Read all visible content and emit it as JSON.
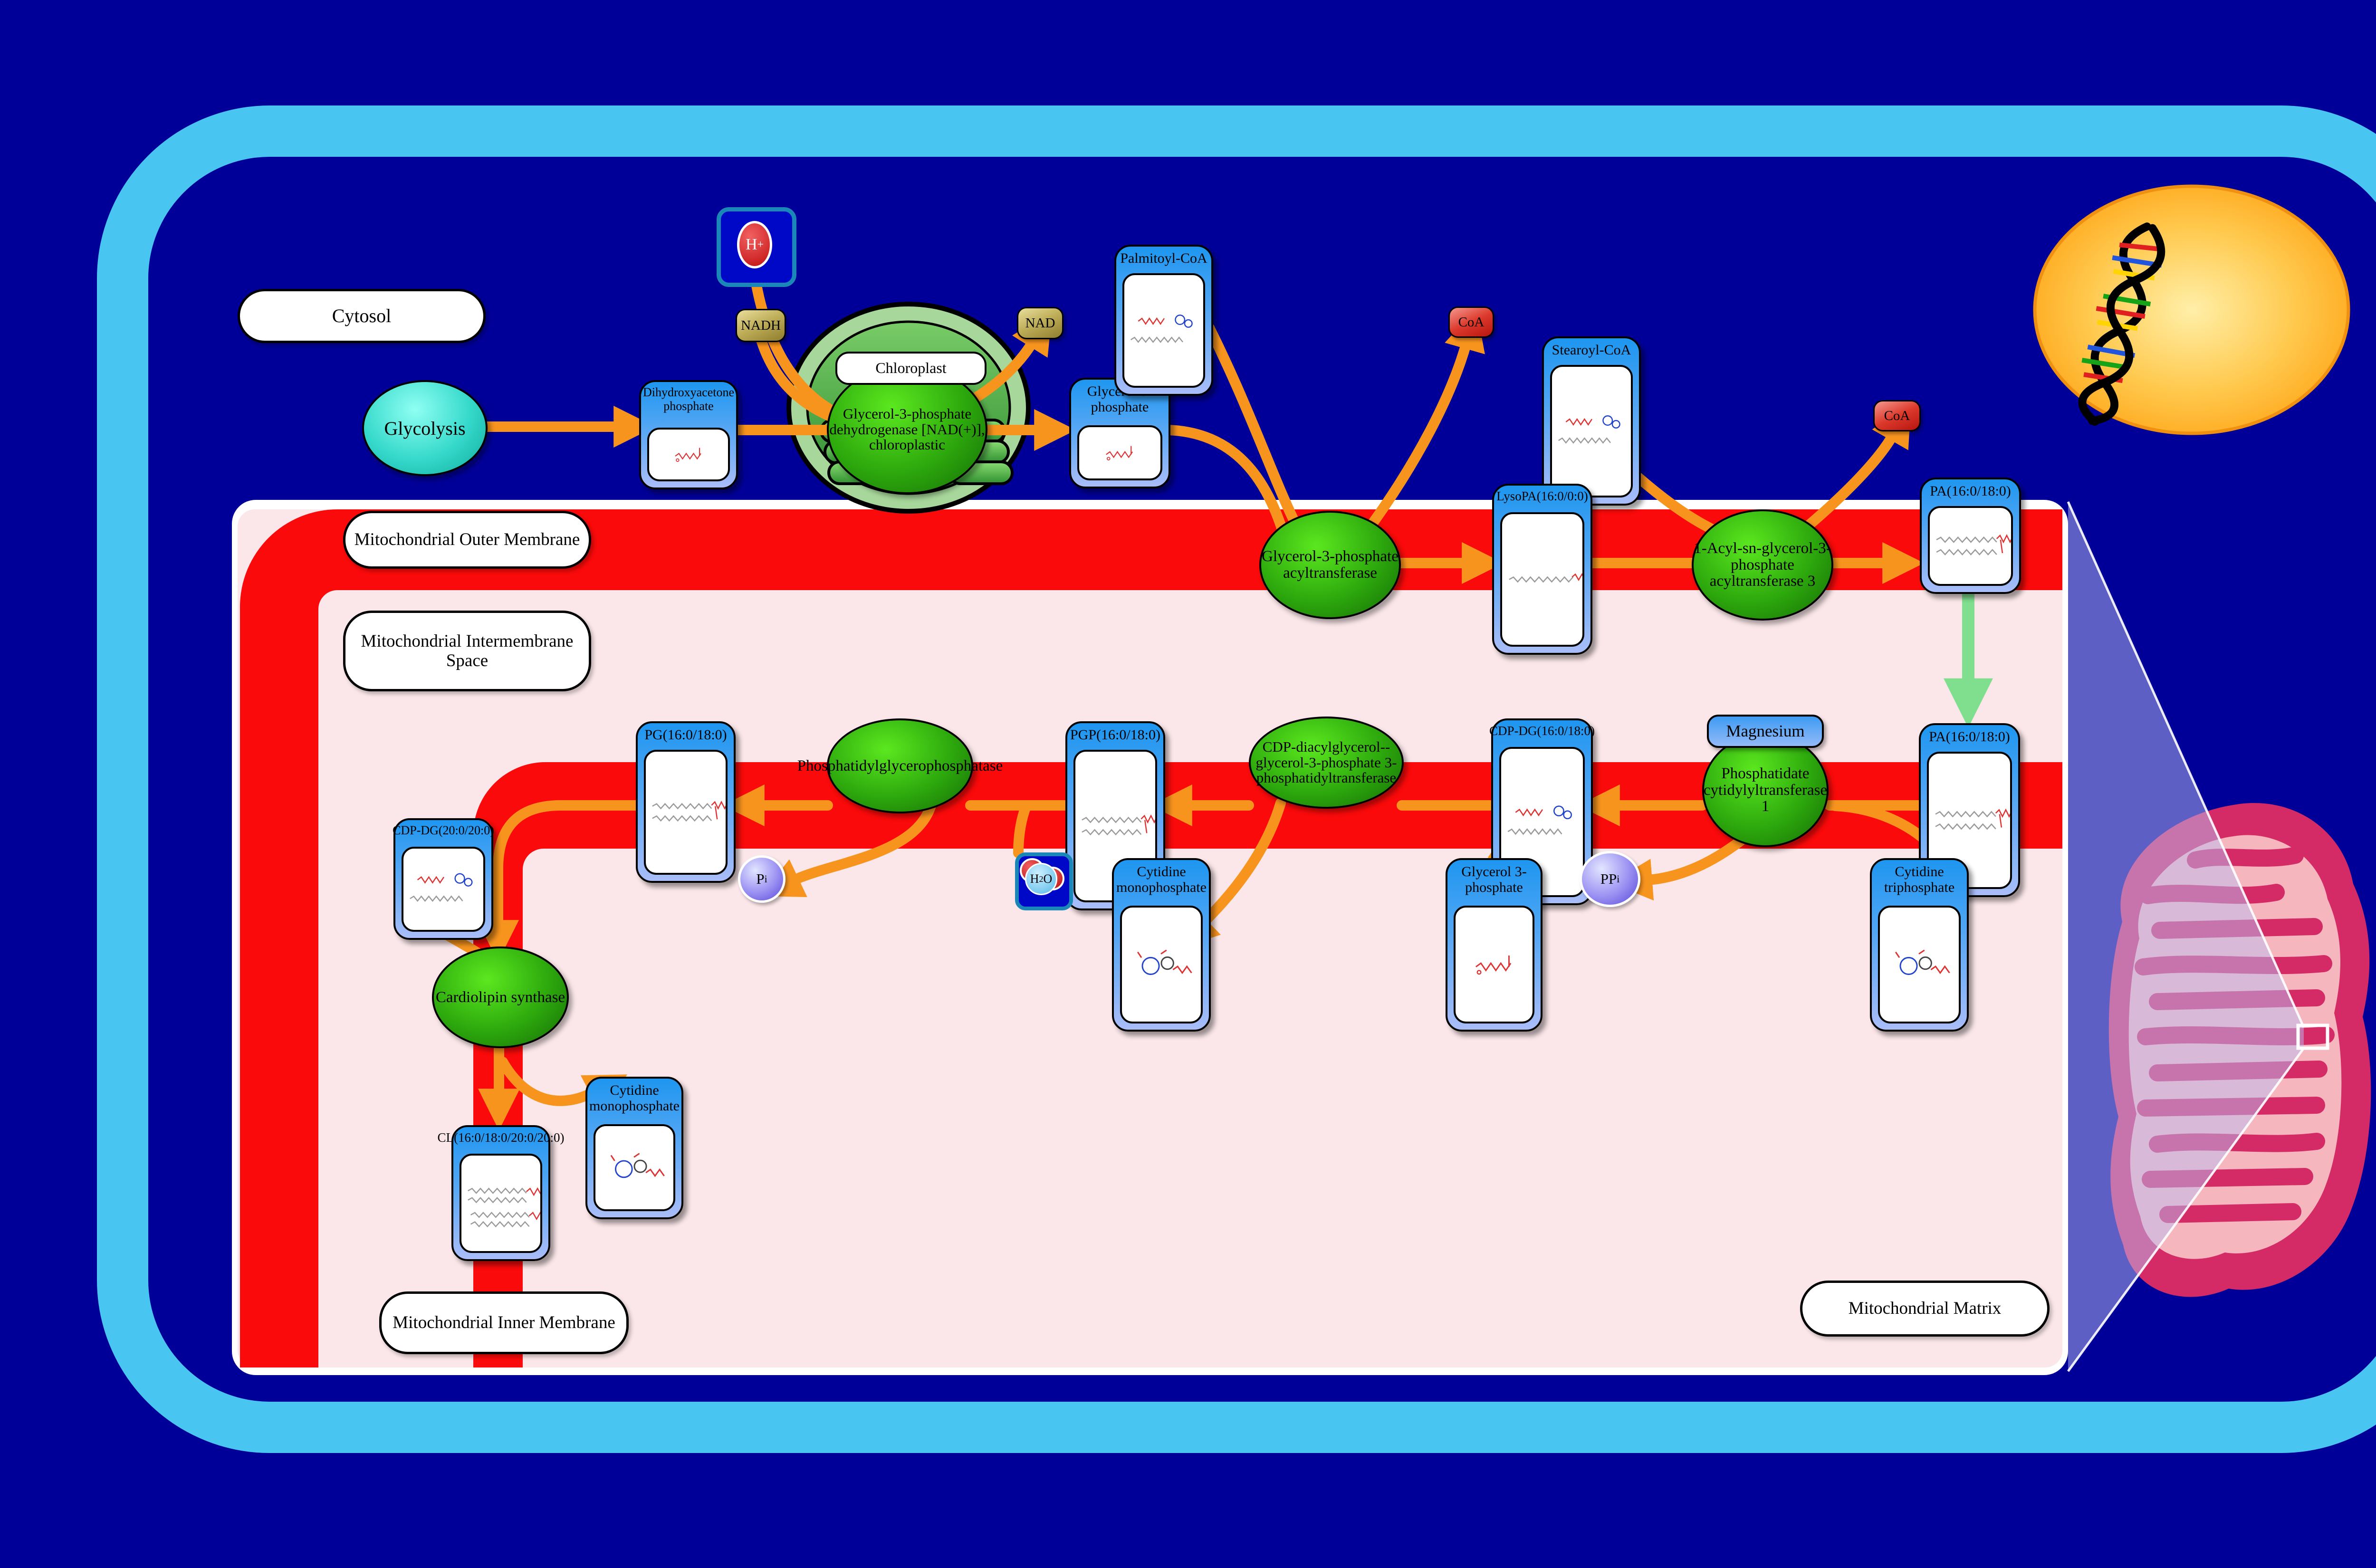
{
  "regions": {
    "cytosol": "Cytosol",
    "chloroplast": "Chloroplast",
    "outer_membrane": "Mitochondrial Outer Membrane",
    "intermembrane_space": "Mitochondrial Intermembrane Space",
    "inner_membrane": "Mitochondrial Inner Membrane",
    "matrix": "Mitochondrial Matrix"
  },
  "nodes": {
    "glycolysis": "Glycolysis"
  },
  "enzymes": {
    "gpd_chloroplastic": "Glycerol-3-phosphate dehydrogenase [NAD(+)], chloroplastic",
    "gpat": "Glycerol-3-phosphate acyltransferase",
    "agpat3": "1-Acyl-sn-glycerol-3-phosphate acyltransferase 3",
    "cds1": "Phosphatidate cytidylyltransferase 1",
    "cds1_cofactor": "Magnesium",
    "pgs1": "CDP-diacylglycerol--glycerol-3-phosphate 3-phosphatidyltransferase",
    "pgp_phosphatase": "Phosphatidylglycerophosphatase",
    "cardiolipin_synthase": "Cardiolipin synthase"
  },
  "compounds": {
    "dhap": "Dihydroxyacetone phosphate",
    "g3p_top": "Glycerol 3-phosphate",
    "palmitoyl_coa": "Palmitoyl-CoA",
    "stearoyl_coa": "Stearoyl-CoA",
    "lysopa": "LysoPA(16:0/0:0)",
    "pa_outer": "PA(16:0/18:0)",
    "pa_matrix": "PA(16:0/18:0)",
    "cdp_dg_1": "CDP-DG(16:0/18:0)",
    "pgp": "PGP(16:0/18:0)",
    "pg": "PG(16:0/18:0)",
    "cdp_dg_2": "CDP-DG(20:0/20:0)",
    "cl": "CL(16:0/18:0/20:0/20:0)",
    "cmp_left": "Cytidine monophosphate",
    "cmp_mid": "Cytidine monophosphate",
    "g3p_bottom": "Glycerol 3-phosphate",
    "ctp": "Cytidine triphosphate"
  },
  "cofactors": {
    "nadh": "NADH",
    "nad": "NAD",
    "h_plus_base": "H",
    "h_plus_sup": "+",
    "coa_1": "CoA",
    "coa_2": "CoA",
    "ppi_base": "PP",
    "ppi_sub": "i",
    "pi_base": "P",
    "pi_sub": "i",
    "h2o_h": "H",
    "h2o_2": "2",
    "h2o_o": "O"
  },
  "colors": {
    "background_navy": "#000098",
    "cell_border_blue": "#49C5F1",
    "membrane_red": "#FA0A0A",
    "matrix_pink": "#FBE7EA",
    "arrow_orange": "#F7941E",
    "arrow_green": "#7FDF8F",
    "enzyme_green": "#2DA80D",
    "compound_blue": "#1E96F0",
    "nucleus_yellow": "#FFB92E",
    "mitochondrion_crimson": "#D42A66"
  }
}
